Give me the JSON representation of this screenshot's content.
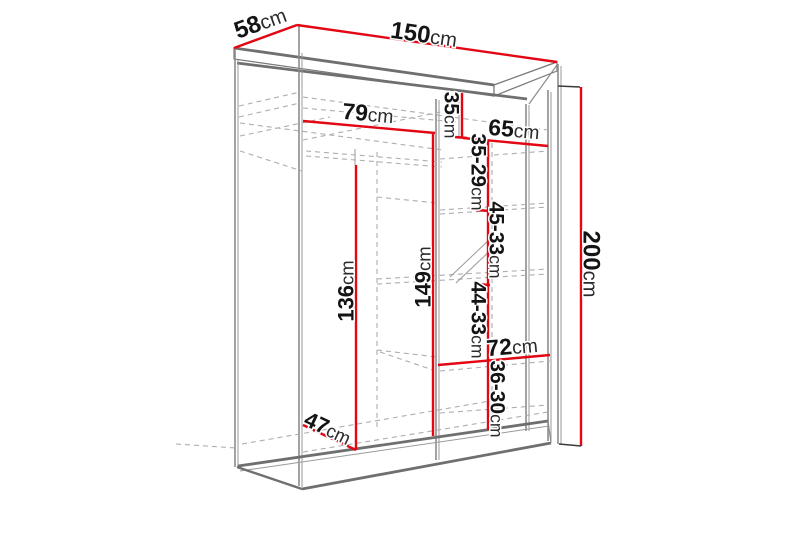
{
  "diagram": {
    "title": "Sliding-door wardrobe dimension drawing",
    "unit": "cm",
    "colors": {
      "dimension_line": "#e30613",
      "structure_line": "#6f6f6f",
      "hidden_line": "#aeaeae",
      "label_text": "#141414",
      "background": "#ffffff"
    },
    "dimensions": [
      {
        "id": "top-depth",
        "num": "58",
        "unit": "cm"
      },
      {
        "id": "top-width",
        "num": "150",
        "unit": "cm"
      },
      {
        "id": "left-section-width",
        "num": "79",
        "unit": "cm"
      },
      {
        "id": "top-shelf-height",
        "num": "35",
        "unit": "cm"
      },
      {
        "id": "right-section-width",
        "num": "65",
        "unit": "cm"
      },
      {
        "id": "shelf-gap-1",
        "num": "35-29",
        "unit": "cm"
      },
      {
        "id": "shelf-gap-2",
        "num": "45-33",
        "unit": "cm"
      },
      {
        "id": "hanging-height",
        "num": "136",
        "unit": "cm"
      },
      {
        "id": "middle-column-height",
        "num": "149",
        "unit": "cm"
      },
      {
        "id": "shelf-gap-3",
        "num": "44-33",
        "unit": "cm"
      },
      {
        "id": "bottom-shelf-width",
        "num": "72",
        "unit": "cm"
      },
      {
        "id": "shelf-gap-4",
        "num": "36-30",
        "unit": "cm"
      },
      {
        "id": "interior-depth",
        "num": "47",
        "unit": "cm"
      },
      {
        "id": "total-height",
        "num": "200",
        "unit": "cm"
      }
    ]
  }
}
